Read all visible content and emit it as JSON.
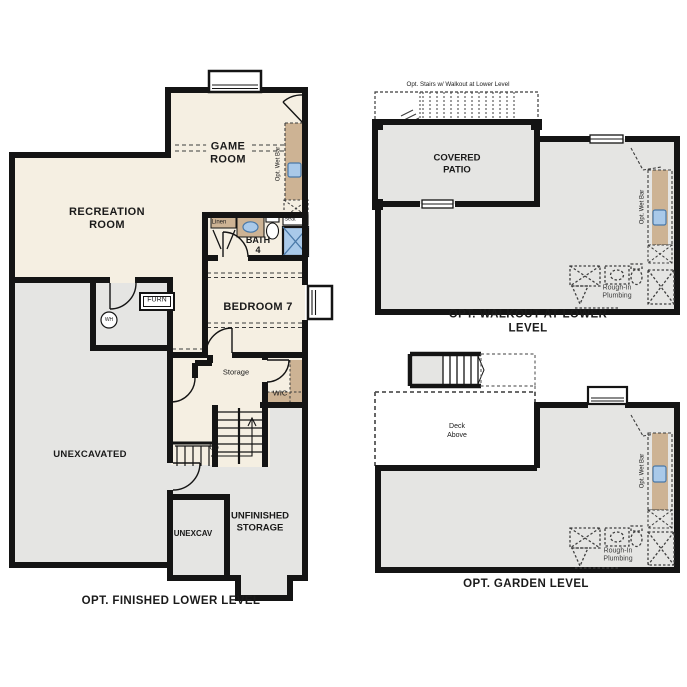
{
  "sheet_title": "Lower level options floor plans",
  "colors": {
    "wall": "#141414",
    "finished": "#f5efe2",
    "unfinished": "#e5e5e3",
    "counter": "#cdb394",
    "fixture_blue": "#a9c9e9",
    "fixture_blue_line": "#4a79a8",
    "dashed_line": "#3c3c3c",
    "rough_in": "#3f3f3f"
  },
  "shared": {
    "opt_wet_bar": "Opt. Wet Bar",
    "rough_in_plumbing": "Rough-In\nPlumbing"
  },
  "finished_lower": {
    "caption": "OPT. FINISHED LOWER LEVEL",
    "labels": {
      "game_room": "GAME\nROOM",
      "recreation_room": "RECREATION\nROOM",
      "bath": "BATH\n4",
      "bedroom": "BEDROOM 7",
      "linen": "Linen",
      "seat": "Seat",
      "furnace": "FURN",
      "water_heater": "WH",
      "unexcavated": "UNEXCAVATED",
      "storage": "Storage",
      "wic": "WIC",
      "up": "Up",
      "unexcav": "UNEXCAV",
      "unfinished_storage": "UNFINISHED\nSTORAGE"
    }
  },
  "walkout": {
    "caption": "OPT. WALKOUT AT LOWER LEVEL",
    "labels": {
      "opt_stairs": "Opt. Stairs w/ Walkout at Lower Level",
      "covered_patio": "COVERED\nPATIO"
    }
  },
  "garden": {
    "caption": "OPT. GARDEN LEVEL",
    "labels": {
      "deck_above": "Deck\nAbove"
    }
  }
}
